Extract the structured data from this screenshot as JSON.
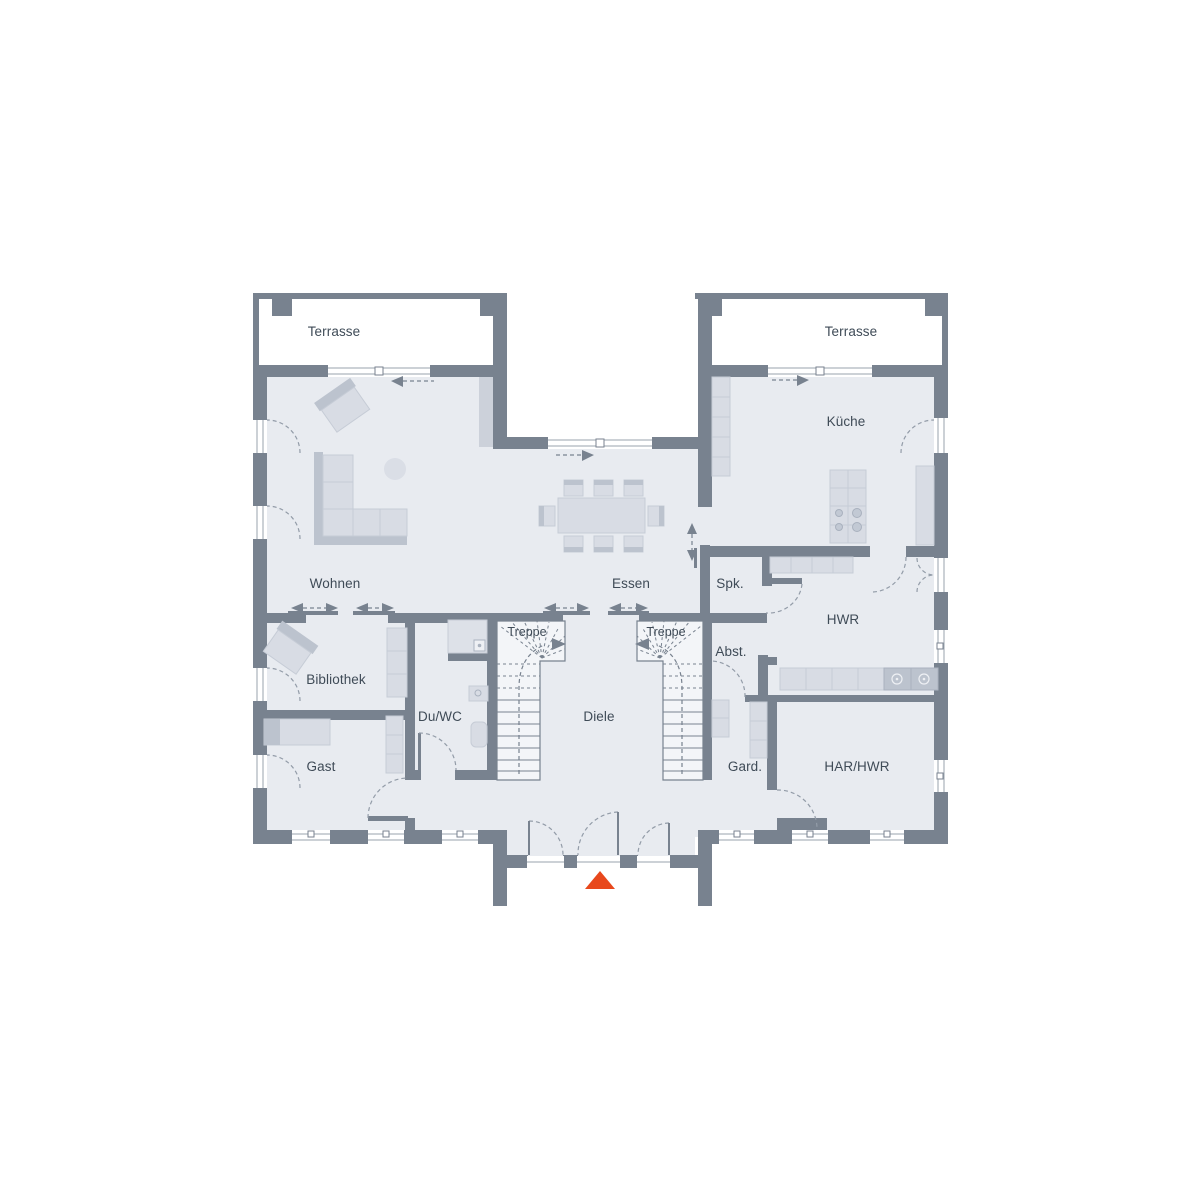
{
  "rooms": [
    {
      "id": "terrasse-west",
      "label": "Terrasse"
    },
    {
      "id": "terrasse-east",
      "label": "Terrasse"
    },
    {
      "id": "kueche",
      "label": "Küche"
    },
    {
      "id": "wohnen",
      "label": "Wohnen"
    },
    {
      "id": "essen",
      "label": "Essen"
    },
    {
      "id": "spk",
      "label": "Spk."
    },
    {
      "id": "treppe-west",
      "label": "Treppe"
    },
    {
      "id": "treppe-east",
      "label": "Treppe"
    },
    {
      "id": "diele",
      "label": "Diele"
    },
    {
      "id": "duwc",
      "label": "Du/WC"
    },
    {
      "id": "bibliothek",
      "label": "Bibliothek"
    },
    {
      "id": "gast",
      "label": "Gast"
    },
    {
      "id": "abst",
      "label": "Abst."
    },
    {
      "id": "hwr",
      "label": "HWR"
    },
    {
      "id": "gard",
      "label": "Gard."
    },
    {
      "id": "har-hwr",
      "label": "HAR/HWR"
    }
  ],
  "icons": {
    "entrance_marker": "triangle-up",
    "passage_arrow": "dashed-arrow",
    "sliding_door_arrow": "double-headed-dashed-arrow"
  },
  "colors": {
    "wall": "#78828f",
    "floor": "#e8ebf0",
    "furniture": "#d8dce4",
    "furniture-dark": "#bcc3ce",
    "furniture-line": "#c6ccd6",
    "panel": "#ccd1da",
    "stair": "#f3f5f8",
    "window-line": "#9aa3ae",
    "arc": "#939ca8",
    "text": "#3f4b57",
    "accent": "#e8481c"
  }
}
